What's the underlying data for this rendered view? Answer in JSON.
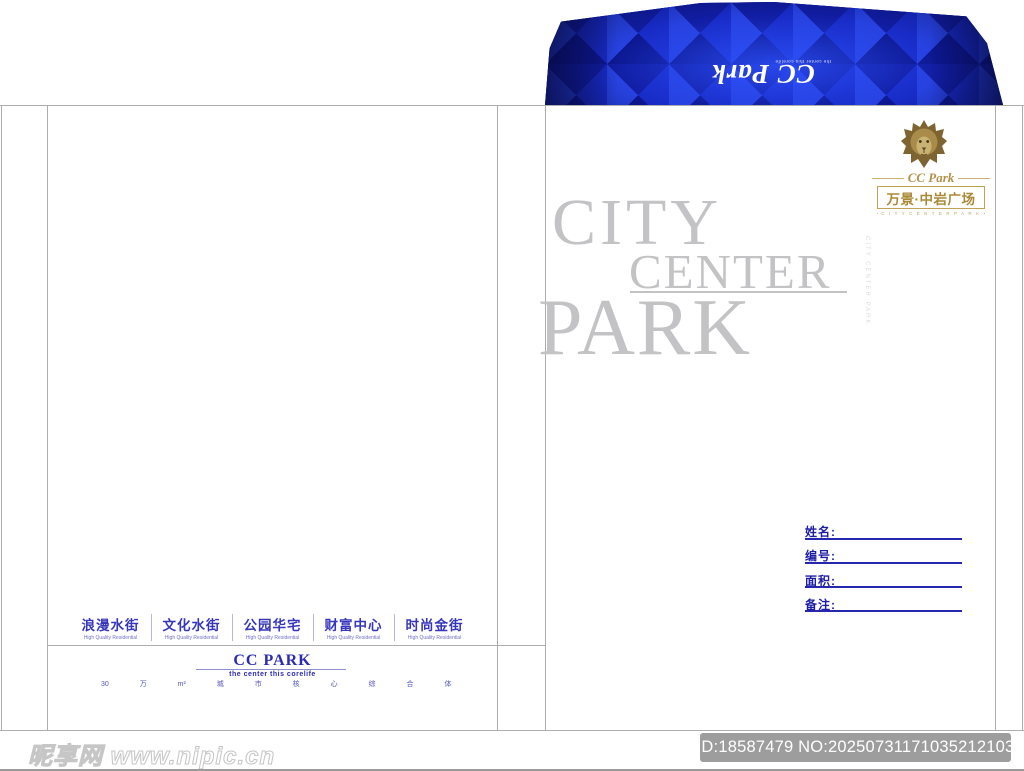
{
  "colors": {
    "flap_blue": "#1a2fce",
    "flap_dark_blue": "#0a1170",
    "gold": "#ab8936",
    "title_gray": "#c3c3c5",
    "form_blue": "#1d1da6",
    "street_blue": "#3636bc",
    "badge_gray": "#9d9d9d"
  },
  "flap": {
    "brand_script": "CC Park",
    "tagline": "the center this corelife"
  },
  "logo": {
    "lion_icon": "gold-lion-head",
    "brand_script": "CC Park",
    "project_name": "万景·中岩广场",
    "caption": "C I T Y   C E N T E R   P A R K"
  },
  "display_title": {
    "line1": "CITY",
    "line2": "CENTER",
    "line3": "PARK",
    "vertical_caption": "CITY CENTER PARK"
  },
  "form_fields": [
    {
      "label": "姓名:"
    },
    {
      "label": "编号:"
    },
    {
      "label": "面积:"
    },
    {
      "label": "备注:"
    }
  ],
  "streets": [
    {
      "name": "浪漫水街",
      "sub": "High Quality Residential"
    },
    {
      "name": "文化水街",
      "sub": "High Quality Residential"
    },
    {
      "name": "公园华宅",
      "sub": "High Quality Residential"
    },
    {
      "name": "财富中心",
      "sub": "High Quality Residential"
    },
    {
      "name": "时尚金街",
      "sub": "High Quality Residential"
    }
  ],
  "back_footer": {
    "brand": "CC PARK",
    "tagline": "the center this corelife",
    "slogan": "30 万 m² 城 市 核 心 综 合 体"
  },
  "watermark": {
    "site_name": "昵享网",
    "site_url": "www.nipic.cn",
    "id_text": "ID:18587479 NO:20250731171035212103"
  }
}
